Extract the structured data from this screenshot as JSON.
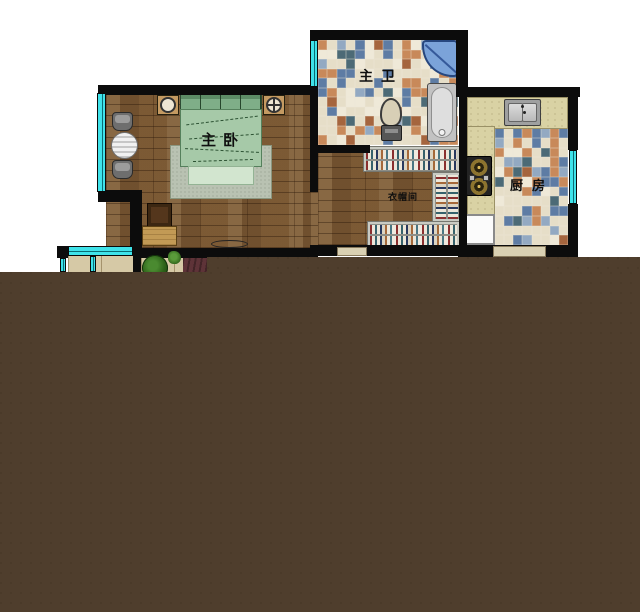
{
  "rooms": {
    "master_bedroom": {
      "label": "主卧"
    },
    "master_bathroom": {
      "label": "主卫"
    },
    "kitchen": {
      "label": "厨房"
    },
    "closet": {
      "label": "衣帽间"
    }
  },
  "colors": {
    "wall": "#0c0c0c",
    "window_glass": "#3fe3ea",
    "wood_floor": "#7b5a36",
    "counter": "#d9d2a4",
    "bed_green": "#a6c9a8",
    "covered_area": "#4f3e2d",
    "tile_cream": "#e6dec8",
    "tile_blue": "#5e7ca4",
    "tile_orange": "#c8895a",
    "tile_teal": "#4c6a76"
  },
  "fixtures": [
    "bed",
    "rug",
    "nightstand",
    "lamp",
    "round-table",
    "chair",
    "desk",
    "desk-chair",
    "tv-stand",
    "corner-shower",
    "bathtub",
    "toilet",
    "kitchen-sink",
    "gas-stove",
    "refrigerator",
    "wardrobe-shelves",
    "balcony-plants",
    "windows"
  ]
}
